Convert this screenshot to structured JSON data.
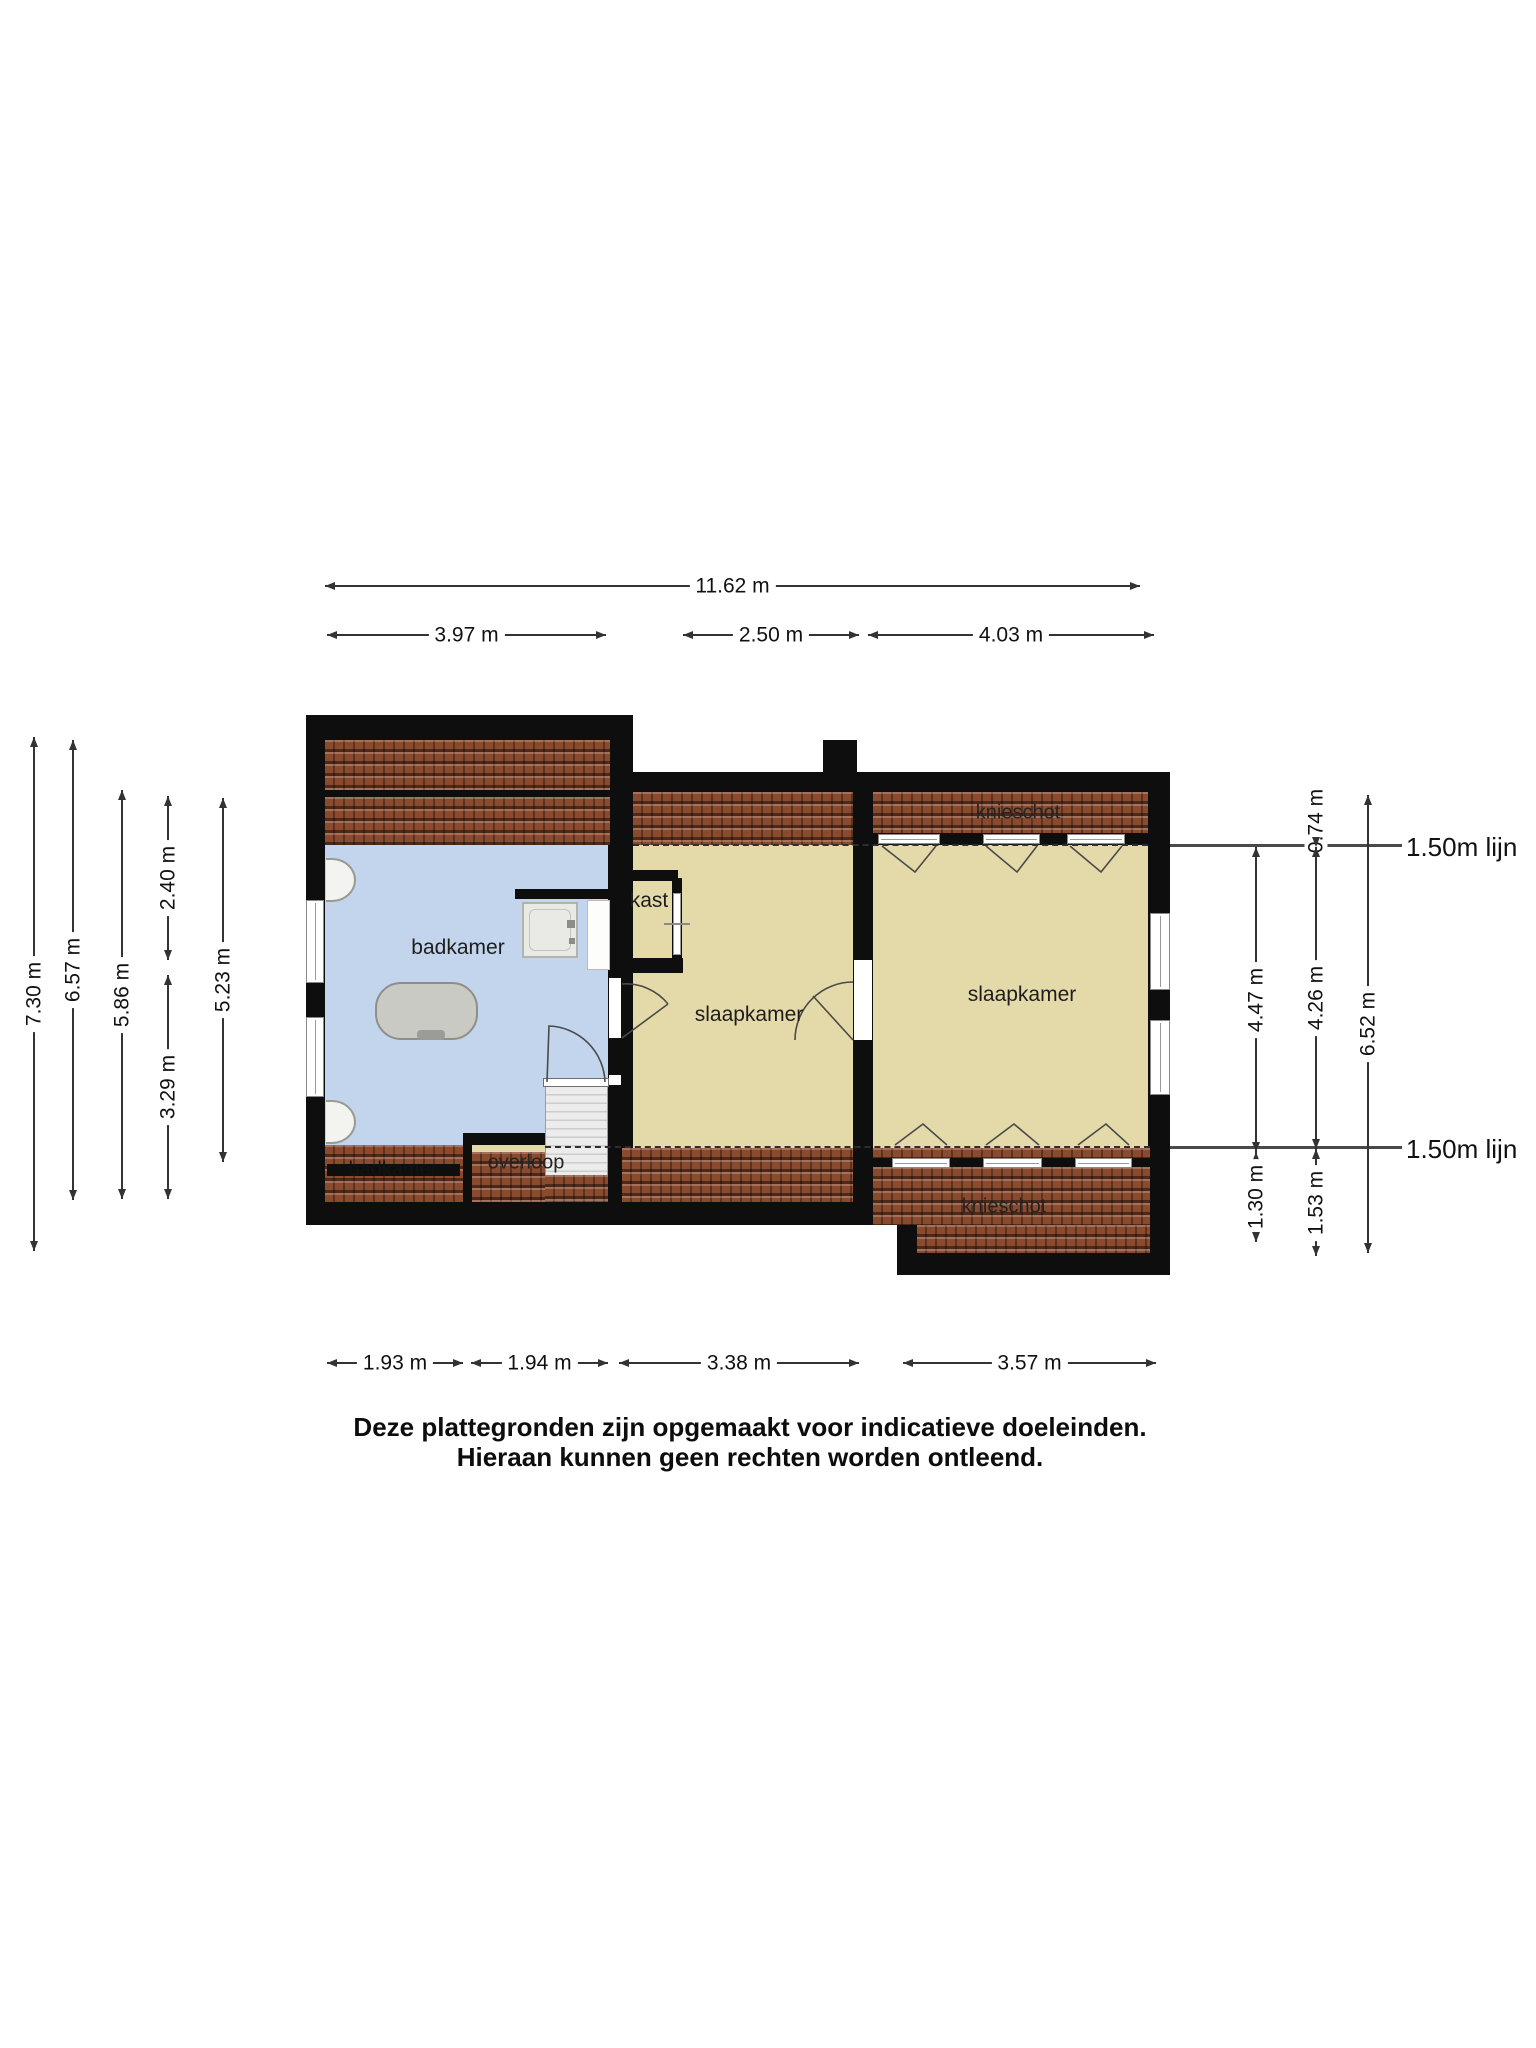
{
  "labels": {
    "badkamer": "badkamer",
    "badkamer_under_roof": "badkamer",
    "kast": "kast",
    "slaapkamer_left": "slaapkamer",
    "slaapkamer_right": "slaapkamer",
    "overloop": "overloop",
    "knieschot_top": "knieschot",
    "knieschot_bottom": "knieschot",
    "line150_top": "1.50m lijn",
    "line150_bottom": "1.50m lijn"
  },
  "dims": {
    "total_width": "11.62 m",
    "top_left": "3.97 m",
    "top_mid": "2.50 m",
    "top_right": "4.03 m",
    "left_1": "7.30 m",
    "left_2": "6.57 m",
    "left_3": "5.86 m",
    "left_4": "2.40 m",
    "left_5": "3.29 m",
    "left_6": "5.23 m",
    "right_1": "4.47 m",
    "right_2": "1.30 m",
    "right_3": "0.74 m",
    "right_4": "4.26 m",
    "right_5": "1.53 m",
    "right_6": "6.52 m",
    "bottom_1": "1.93 m",
    "bottom_2": "1.94 m",
    "bottom_3": "3.38 m",
    "bottom_4": "3.57 m"
  },
  "footer": {
    "line1": "Deze plattegronden zijn opgemaakt voor indicatieve doeleinden.",
    "line2": "Hieraan kunnen geen rechten worden ontleend."
  },
  "colors": {
    "wall": "#0e0e0e",
    "roof": "#8a4a2e",
    "bathroom": "#c2d5ec",
    "room": "#e4daa9",
    "dim": "#333333"
  }
}
